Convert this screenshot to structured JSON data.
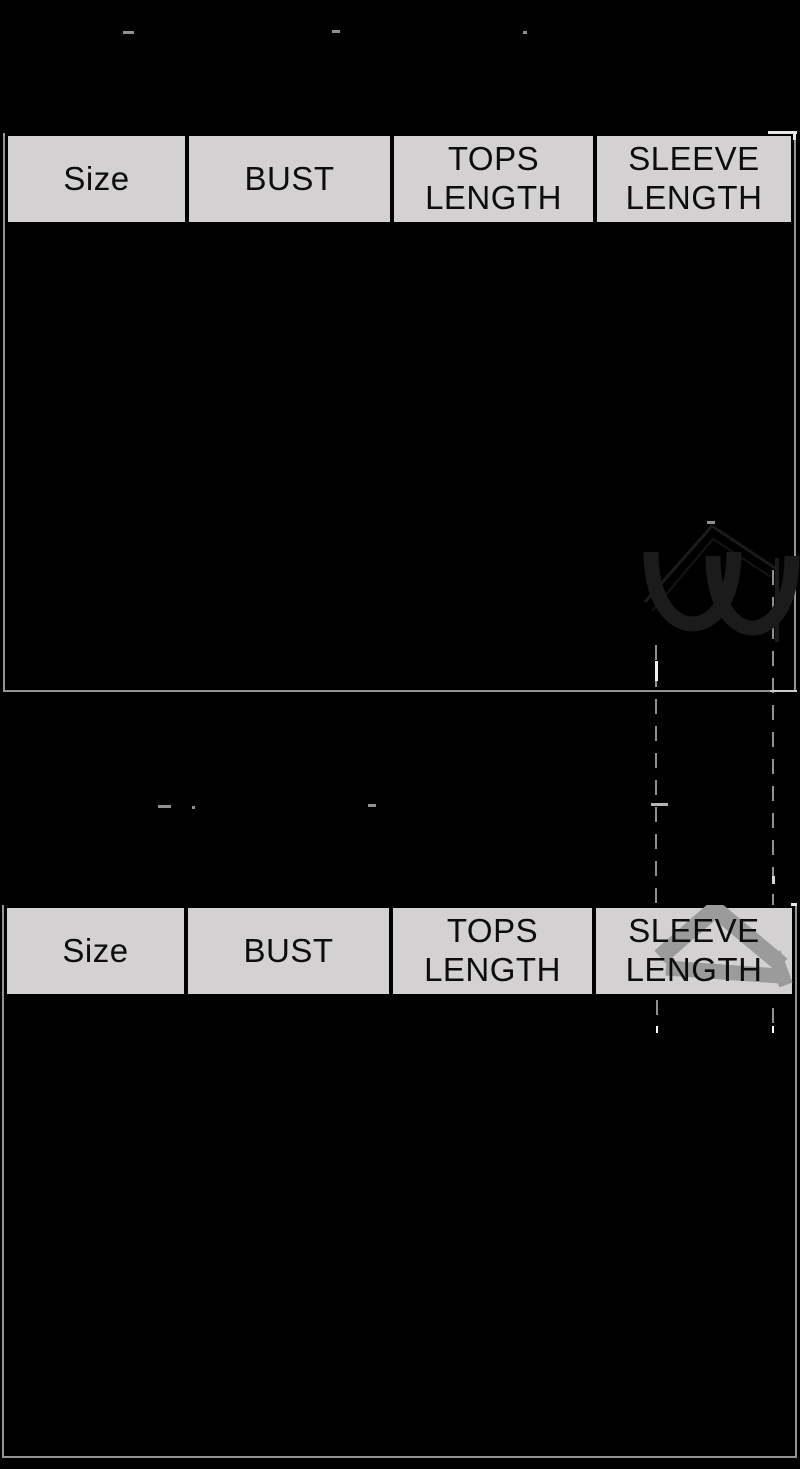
{
  "tables": {
    "table1": {
      "headers": [
        "Size",
        "BUST",
        "TOPS\nLENGTH",
        "SLEEVE\nLENGTH"
      ]
    },
    "table2": {
      "headers": [
        "Size",
        "BUST",
        "TOPS\nLENGTH",
        "SLEEVE\nLENGTH"
      ]
    }
  },
  "icons": {
    "chevron_watermark": "chevron-up",
    "watermark_glyph": "cursive-letter-fragment",
    "measure_lines": "vertical-dashed-measurement-lines"
  },
  "colors": {
    "bg": "#000000",
    "header-bg": "#d3d1d1",
    "header-text": "#0d0d0d",
    "outline": "#949494",
    "dash": "#909090",
    "chevron": "#9b9b9b",
    "watermark": "#1b1b1b",
    "bright": "#efefef"
  }
}
